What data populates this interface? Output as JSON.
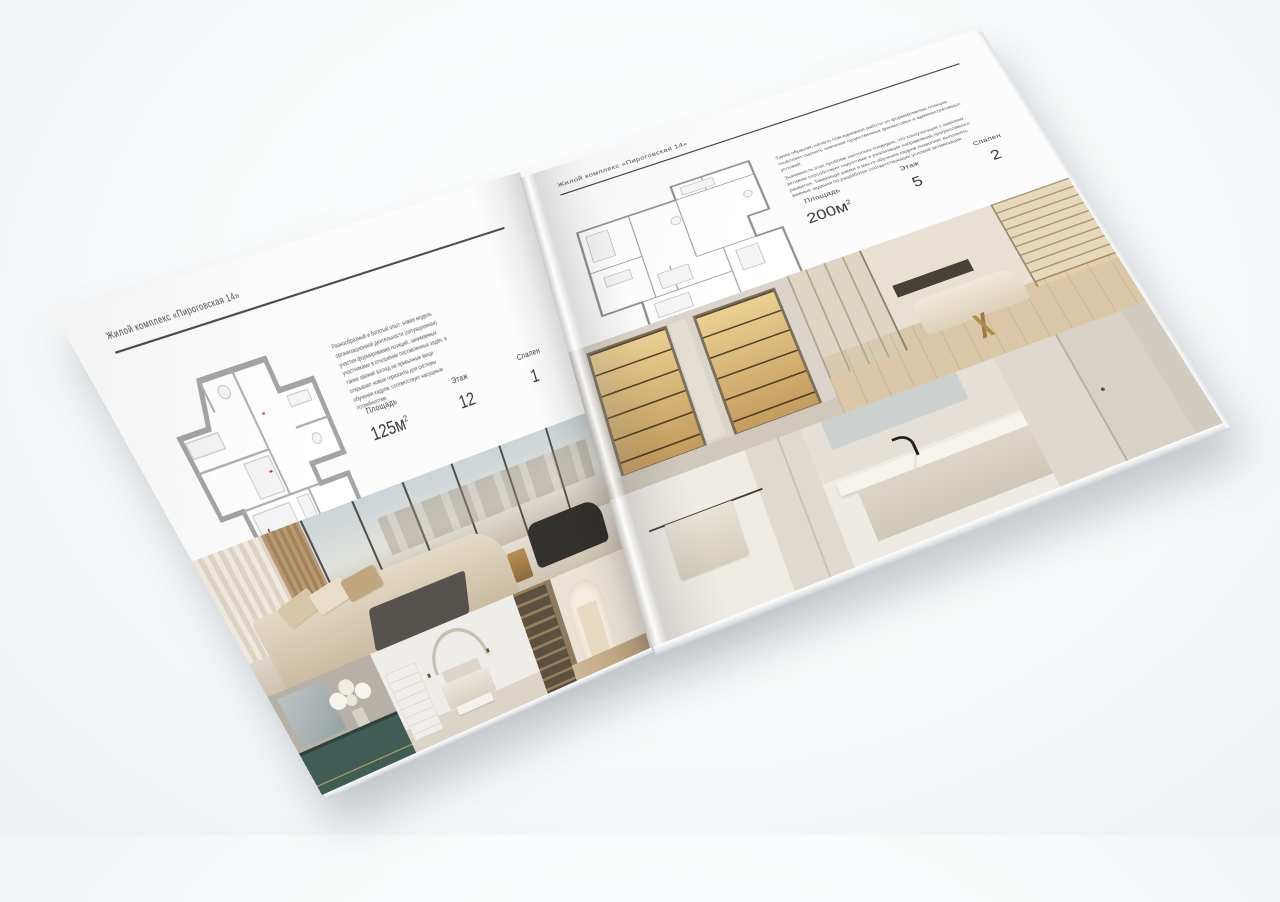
{
  "brochure": {
    "header": "Жилой комплекс «Пироговская 14»",
    "colors": {
      "page": "#fcfcfc",
      "text": "#4a4a4a",
      "rule": "#4e4e4e",
      "plan_walls": "#a4a4a4",
      "dresser_teal": "#415c54",
      "warm_wood": "#b89b74"
    },
    "left_page": {
      "header": "Жилой комплекс «Пироговская 14»",
      "description": "Разнообразный и богатый опыт: новая модель организационной деятельности (ситуационная) участия формирования позиций, занимаемых участниками в отношении поставленных задач, а также свежий взгляд на привычные вещи открывает новые горизонты для системы обучения кадров, соответствует насущным потребностям.",
      "specs": [
        {
          "label": "Площадь",
          "value": "125м",
          "sup": "2"
        },
        {
          "label": "Этаж",
          "value": "12",
          "sup": ""
        },
        {
          "label": "Спален",
          "value": "1",
          "sup": ""
        }
      ]
    },
    "right_page": {
      "header": "Жилой комплекс «Пироговская 14»",
      "description_1": "Таким образом, начало повседневной работы по формированию позиции позволяет оценить значение существенных финансовых и административных условий.",
      "description_2": "Значимость этих проблем настолько очевидна, что консультация с широким активом способствует подготовке и реализации направлений прогрессивного развития. Товарищи! рамки и место обучения кадров позволяет выполнять важные задания по разработке соответствующих условий активизации.",
      "specs": [
        {
          "label": "Площадь",
          "value": "200м",
          "sup": "2"
        },
        {
          "label": "Этаж",
          "value": "5",
          "sup": ""
        },
        {
          "label": "Спален",
          "value": "2",
          "sup": ""
        }
      ]
    }
  }
}
